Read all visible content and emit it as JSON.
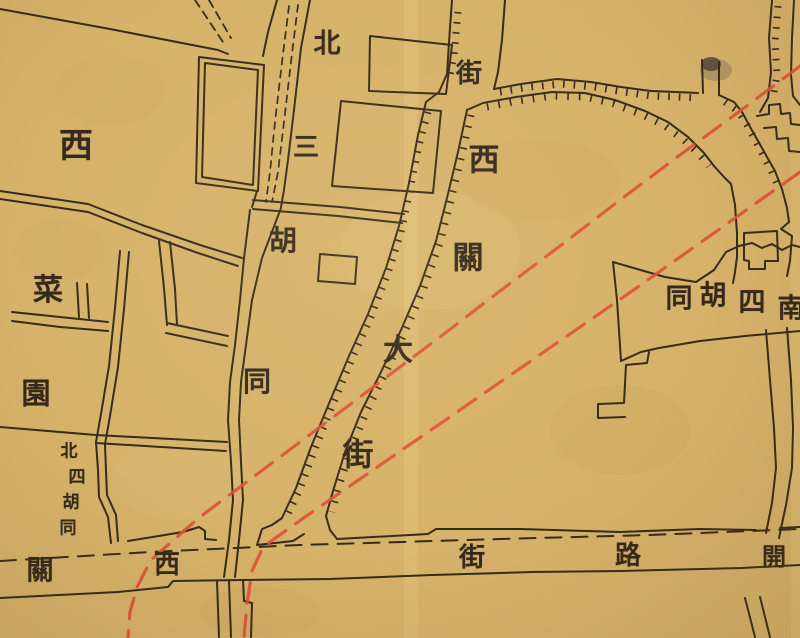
{
  "meta": {
    "kind": "historical-street-map",
    "language": "zh-Hant",
    "drawing_style": "hand-drawn ink on aged paper"
  },
  "palette": {
    "paper": "#d6b26a",
    "ink": "#362a19",
    "red_line": "#df5038"
  },
  "labels": {
    "west_block": {
      "text": "西"
    },
    "cai_yuan": {
      "reading": "菜園",
      "orientation": "vertical",
      "chars": [
        "菜",
        "園"
      ]
    },
    "north_third_hutong": {
      "reading": "北三胡同",
      "orientation": "vertical",
      "chars": [
        "北",
        "三",
        "胡",
        "同"
      ]
    },
    "top_street_partial": {
      "reading": "街",
      "orientation": "vertical",
      "chars": [
        "街"
      ]
    },
    "xiguan_main_street": {
      "reading": "西關大街",
      "orientation": "vertical",
      "chars": [
        "西",
        "關",
        "大",
        "街"
      ]
    },
    "south_fourth_hutong": {
      "reading": "南四胡同",
      "direction": "right-to-left",
      "chars_displayed": [
        "同",
        "胡",
        "四",
        "南"
      ]
    },
    "north_fourth_hutong": {
      "reading": "北四胡同",
      "orientation": "vertical",
      "chars": [
        "北",
        "四",
        "胡",
        "同"
      ]
    },
    "bottom_street_west": {
      "reading": "西關",
      "direction": "right-to-left",
      "chars_displayed": [
        "關",
        "西"
      ]
    },
    "bottom_street_east": {
      "reading": "開路街",
      "direction": "right-to-left",
      "chars_displayed": [
        "街",
        "路",
        "開"
      ]
    }
  },
  "features": {
    "red_overlay_lines": {
      "count": 2,
      "style": "dashed",
      "color": "#df5038"
    },
    "main_street": {
      "hatched": true
    },
    "bottom_street": {
      "centerline": "dashed"
    },
    "north_third_hutong_lane": {
      "interior": "double dashed"
    }
  }
}
